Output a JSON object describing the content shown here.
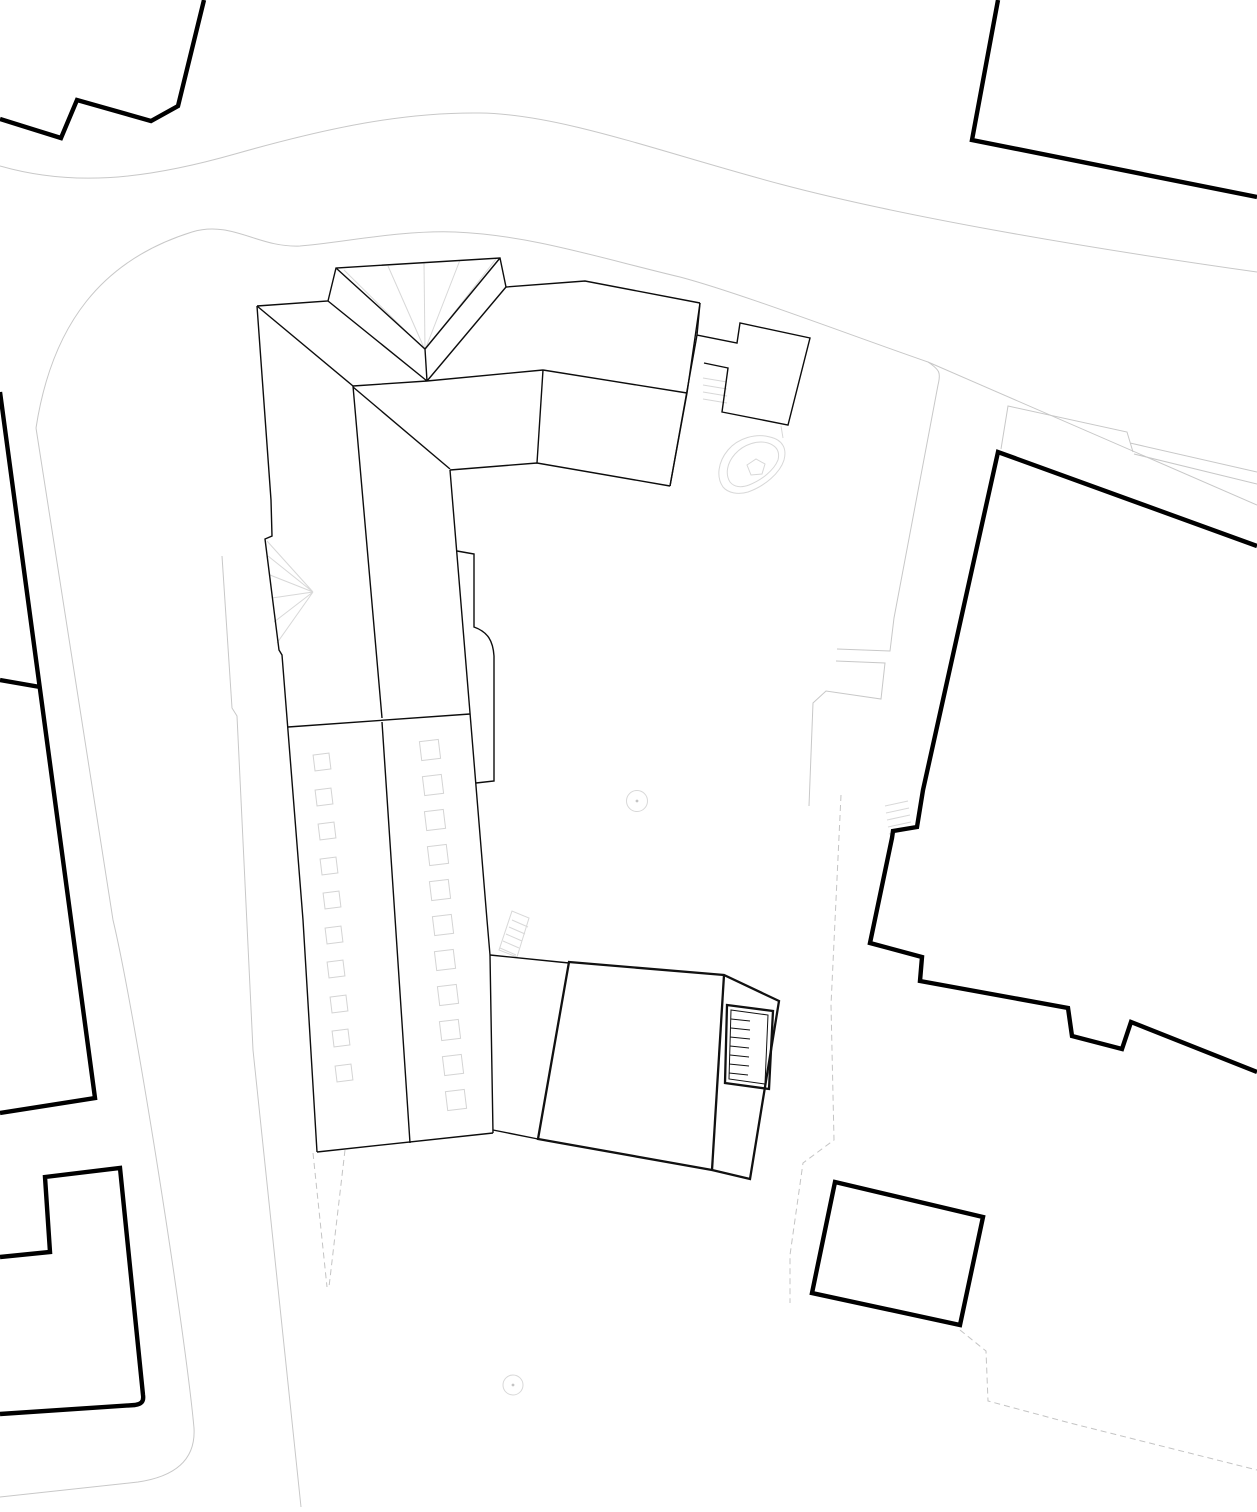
{
  "canvas": {
    "width": 1257,
    "height": 1512,
    "background": "#ffffff"
  },
  "colors": {
    "context_building": "#000000",
    "secondary_building": "#111111",
    "main_complex": "#0d0d0d",
    "road_line": "#c8c8c8",
    "dashed_line": "#c4c4c4",
    "detail_line": "#d8d8d8"
  },
  "layers": [
    {
      "name": "roads-and-paths",
      "stroke": "#c8c8c8",
      "width": 1,
      "paths": [
        {
          "name": "road-north-edge",
          "d": "M0,166 C70,186 140,181 235,154 C330,127 405,112 480,113 C560,114 660,152 780,184 C900,216 1080,247 1257,272"
        },
        {
          "name": "road-block-curve",
          "d": "M36,428 C52,324 102,260 192,232 C232,220 258,248 300,246 C340,243 400,230 455,232 C530,235 600,258 680,277 C740,293 850,335 928,362"
        },
        {
          "name": "courtyard-wall-east",
          "d": "M928,362 C940,370 941,373 938,385 L894,618 L890,651 L837,649"
        },
        {
          "name": "street-curb-east",
          "d": "M928,362 L1257,505"
        },
        {
          "name": "path-left-inner",
          "d": "M222,556 L232,708 L237,716 L253,1050 L301,1507"
        },
        {
          "name": "path-left-outer",
          "d": "M36,428 L113,920 C135,1012 185,1330 194,1428 C196,1462 172,1477 138,1482 L0,1497"
        },
        {
          "name": "pavement-band-right",
          "d": "M1001,449 L1008,406 L1127,432 L1133,452 M1130,443 L1257,472 M1134,454 L1257,484"
        },
        {
          "name": "terrace-steps-court",
          "d": "M836,661 L885,663 L881,699 L826,691 L813,703 L809,806"
        }
      ]
    },
    {
      "name": "property-dashed",
      "stroke": "#c4c4c4",
      "width": 1,
      "dash": "6 4",
      "paths": [
        {
          "name": "dashed-boundary-court",
          "d": "M841,795 L831,1005 L834,1140 L803,1163 L790,1255 L790,1303"
        },
        {
          "name": "dashed-boundary-southeast",
          "d": "M960,1330 L986,1351 L988,1401 L1070,1423 L1257,1470"
        },
        {
          "name": "dashed-wedge-southwest",
          "d": "M313,1153 L327,1287 M345,1150 L329,1287"
        }
      ]
    },
    {
      "name": "site-details",
      "stroke": "#d8d8d8",
      "width": 1,
      "paths": [
        {
          "name": "stair-hatch-right-building",
          "d": "M885,806 L908,801 M886,813 L909,808 M887,820 L910,815 M888,827 L911,822 M889,834 L912,829"
        },
        {
          "name": "stair-hatch-wing",
          "d": "M499,950 L512,911 L529,918 L517,957 Z M500,948 L516,955 M503,941 L519,948 M506,934 L522,941 M509,927 L525,934 M512,920 L528,927"
        },
        {
          "name": "stair-hatch-annex",
          "d": "M703,378 L727,382 M703,385 L727,389 M703,392 L727,396 M703,399 L727,403"
        },
        {
          "name": "planter-leaf-outer",
          "d": "M723,487 C716,477 718,462 728,450 C738,438 756,433 770,437 C783,440 787,449 784,460 C780,473 765,486 748,492 C738,495 728,493 723,487 Z"
        },
        {
          "name": "planter-leaf-inner",
          "d": "M730,482 C725,474 727,463 735,454 C744,444 758,440 768,443 C777,446 780,452 778,460 C774,470 762,480 749,485 C741,488 734,487 730,482 Z"
        },
        {
          "name": "planter-pentagon",
          "d": "M747,465 L756,459 L765,464 L762,474 L751,475 Z"
        },
        {
          "name": "planter-stem",
          "d": "M781,426 L783,438"
        },
        {
          "name": "bay-roof-fan-west",
          "d": "M313,592 L267,541 M313,592 L268,556 M313,592 L270,575 M313,592 L272,598 M313,592 L274,622 M313,592 L277,643"
        },
        {
          "name": "bay-roof-fan-north",
          "d": "M425,350 L344,270 M425,350 L388,266 M425,350 L424,262 M425,350 L460,260 M425,350 L496,259"
        }
      ]
    },
    {
      "name": "tree-symbols",
      "stroke": "#d8d8d8",
      "width": 1,
      "circles": [
        {
          "name": "tree-circle-court",
          "cx": 637,
          "cy": 801,
          "r": 10.5
        },
        {
          "name": "tree-dot-court",
          "cx": 637,
          "cy": 801,
          "r": 1.4,
          "fill": "#c4c4c4"
        },
        {
          "name": "tree-circle-south",
          "cx": 513,
          "cy": 1385,
          "r": 10
        },
        {
          "name": "tree-dot-south",
          "cx": 513,
          "cy": 1385,
          "r": 1.4,
          "fill": "#c4c4c4"
        }
      ]
    },
    {
      "name": "main-complex",
      "stroke": "#0d0d0d",
      "width": 1.4,
      "paths": [
        {
          "name": "wing-west-edge",
          "d": "M257,306 L271,500 L272,536 L265,539 L279,650 L282,655 L303,920 L317,1152"
        },
        {
          "name": "wing-south-edge",
          "d": "M317,1152 L493,1133"
        },
        {
          "name": "wing-east-facade",
          "d": "M450,470 L470,713 L487,920 L490,955 L493,1133"
        },
        {
          "name": "wing-transverse-line",
          "d": "M288,727 L470,714"
        },
        {
          "name": "wing-ridge",
          "d": "M353,386 L382,718 M382,722 L410,1143"
        },
        {
          "name": "wing-hip-northwest",
          "d": "M257,306 L353,386"
        },
        {
          "name": "wing-hip-courtyard",
          "d": "M353,387 L450,469"
        },
        {
          "name": "head-north-eave",
          "d": "M257,306 L328,301 L336,268 L500,258 L506,287 L585,281 L700,303"
        },
        {
          "name": "head-bay-valleys",
          "d": "M328,301 L427,381 M506,287 L427,381 M336,268 L425,349 M500,258 L425,349 M425,349 L427,381 M353,386 L427,381"
        },
        {
          "name": "head-ridge",
          "d": "M543,370 L687,393"
        },
        {
          "name": "head-hip-west",
          "d": "M427,381 L543,370 M543,370 L537,463"
        },
        {
          "name": "head-hip-east",
          "d": "M687,393 L700,303 M687,393 L670,486"
        },
        {
          "name": "head-south-eave",
          "d": "M450,470 L537,463 L670,486"
        },
        {
          "name": "head-east-eave",
          "d": "M670,486 L697,335"
        },
        {
          "name": "annex-outline",
          "d": "M700,303 L697,335 L737,343 L740,323 L810,338 L788,425 L722,412 L728,368 L704,363"
        },
        {
          "name": "terrace-strip-east",
          "d": "M457,551 L474,554 L474,627 C488,632 493,641 494,656 L494,781 L476,783"
        },
        {
          "name": "link-north-edge",
          "d": "M490,955 L569,963"
        },
        {
          "name": "link-south-edge",
          "d": "M493,1130 L538,1139"
        }
      ]
    },
    {
      "name": "skylights",
      "stroke": "#d4d4d4",
      "width": 1,
      "rot": -7,
      "rects": [
        {
          "name": "skylight",
          "cx": 322,
          "cy": 762,
          "s": 16
        },
        {
          "name": "skylight",
          "cx": 324,
          "cy": 797,
          "s": 16
        },
        {
          "name": "skylight",
          "cx": 327,
          "cy": 831,
          "s": 16
        },
        {
          "name": "skylight",
          "cx": 329,
          "cy": 866,
          "s": 16
        },
        {
          "name": "skylight",
          "cx": 332,
          "cy": 900,
          "s": 16
        },
        {
          "name": "skylight",
          "cx": 334,
          "cy": 935,
          "s": 16
        },
        {
          "name": "skylight",
          "cx": 336,
          "cy": 969,
          "s": 16
        },
        {
          "name": "skylight",
          "cx": 339,
          "cy": 1004,
          "s": 16
        },
        {
          "name": "skylight",
          "cx": 341,
          "cy": 1038,
          "s": 16
        },
        {
          "name": "skylight",
          "cx": 344,
          "cy": 1073,
          "s": 16
        },
        {
          "name": "skylight",
          "cx": 430,
          "cy": 750,
          "s": 19
        },
        {
          "name": "skylight",
          "cx": 433,
          "cy": 785,
          "s": 19
        },
        {
          "name": "skylight",
          "cx": 435,
          "cy": 820,
          "s": 19
        },
        {
          "name": "skylight",
          "cx": 438,
          "cy": 855,
          "s": 19
        },
        {
          "name": "skylight",
          "cx": 440,
          "cy": 890,
          "s": 19
        },
        {
          "name": "skylight",
          "cx": 443,
          "cy": 925,
          "s": 19
        },
        {
          "name": "skylight",
          "cx": 445,
          "cy": 960,
          "s": 19
        },
        {
          "name": "skylight",
          "cx": 448,
          "cy": 995,
          "s": 19
        },
        {
          "name": "skylight",
          "cx": 450,
          "cy": 1030,
          "s": 19
        },
        {
          "name": "skylight",
          "cx": 453,
          "cy": 1065,
          "s": 19
        },
        {
          "name": "skylight",
          "cx": 456,
          "cy": 1100,
          "s": 19
        }
      ]
    },
    {
      "name": "pavilion-building",
      "stroke": "#111111",
      "width": 2.3,
      "paths": [
        {
          "name": "pavilion-outline",
          "d": "M569,962 L724,975 L779,1001 L750,1179 L712,1170 L538,1139 Z"
        },
        {
          "name": "pavilion-division",
          "d": "M724,975 L712,1170"
        },
        {
          "name": "pavilion-stair-outer",
          "d": "M727,1005 L773,1011 L769,1089 L725,1083 Z"
        }
      ]
    },
    {
      "name": "pavilion-stair-detail",
      "stroke": "#111111",
      "width": 1,
      "paths": [
        {
          "name": "pavilion-stair-inner",
          "d": "M731,1010 L768,1015 L765,1084 L729,1079 Z"
        },
        {
          "name": "pavilion-stair-treads",
          "d": "M731,1019 L750,1021 M731,1028 L750,1030 M730,1037 L750,1039 M730,1046 L749,1048 M730,1055 L749,1057 M729,1064 L749,1066 M729,1073 L748,1075"
        }
      ]
    },
    {
      "name": "context-buildings",
      "stroke": "#000000",
      "width": 4.4,
      "paths": [
        {
          "name": "building-northwest-fragment",
          "d": "M204,0 L178,106 L151,121 L77,100 L61,138 L0,119"
        },
        {
          "name": "building-northeast",
          "d": "M998,0 L972,140 L1257,197"
        },
        {
          "name": "building-east-large",
          "d": "M1257,546 L998,452 L923,790 L917,827 L893,831 L892,838 L870,943 L922,957 L920,981 L1068,1008 L1072,1036 L1122,1049 L1131,1022 L1257,1072"
        },
        {
          "name": "building-south-small",
          "d": "M835,1182 L983,1217 L960,1325 L812,1293 Z"
        },
        {
          "name": "building-southwest-upper",
          "d": "M0,392 L95,1098 L0,1113 M0,680 L40,687"
        },
        {
          "name": "building-southwest-lower",
          "d": "M0,1257 L50,1252 L45,1177 L120,1168 L143,1395 C144,1402 141,1404 135,1405 L0,1414"
        }
      ]
    }
  ]
}
